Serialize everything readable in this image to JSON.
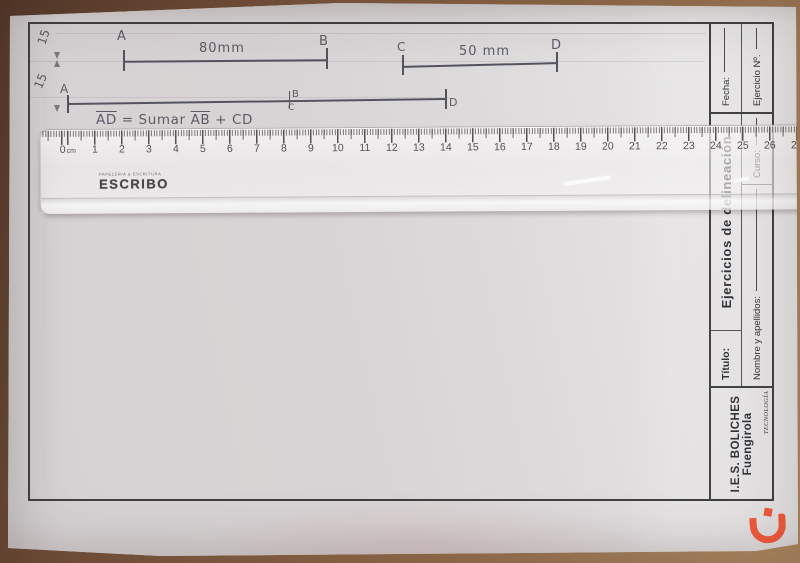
{
  "worksheet": {
    "margin_marks": {
      "upper": "15",
      "lower": "15"
    },
    "segments": {
      "ab": {
        "start": "A",
        "end": "B",
        "length": "80mm"
      },
      "cd": {
        "start": "C",
        "end": "D",
        "length": "50 mm"
      }
    },
    "result_line": {
      "start": "A",
      "junction_top": "B",
      "junction_bottom": "C",
      "end": "D"
    },
    "formula": {
      "lhs": "AD",
      "mid": "= Sumar",
      "rhs1": "AB",
      "tail": "+ CD"
    },
    "title_block": {
      "fecha": "Fecha:",
      "ejercicio": "Ejercicio Nº.",
      "header": "Ejercicios de delineación",
      "titulo": "Título:",
      "nombre": "Nombre y apellidos:",
      "curso": "Curso:",
      "school": "I.E.S. BOLICHES",
      "city": "Fuengirola",
      "dept": "TECNOLOGÍA"
    }
  },
  "ruler": {
    "brand": "ESCRIBO",
    "tagline": "PAPELERIA & ESCRITURA",
    "unit": "cm",
    "numbers": [
      0,
      1,
      2,
      3,
      4,
      5,
      6,
      7,
      8,
      9,
      10,
      11,
      12,
      13,
      14,
      15,
      16,
      17,
      18,
      19,
      20,
      21,
      22,
      23,
      24,
      25,
      26,
      27
    ]
  },
  "colors": {
    "watermark": "#f25a3d",
    "frame": "#403f42",
    "pencil": "#54545e",
    "table": "#8f6847"
  }
}
